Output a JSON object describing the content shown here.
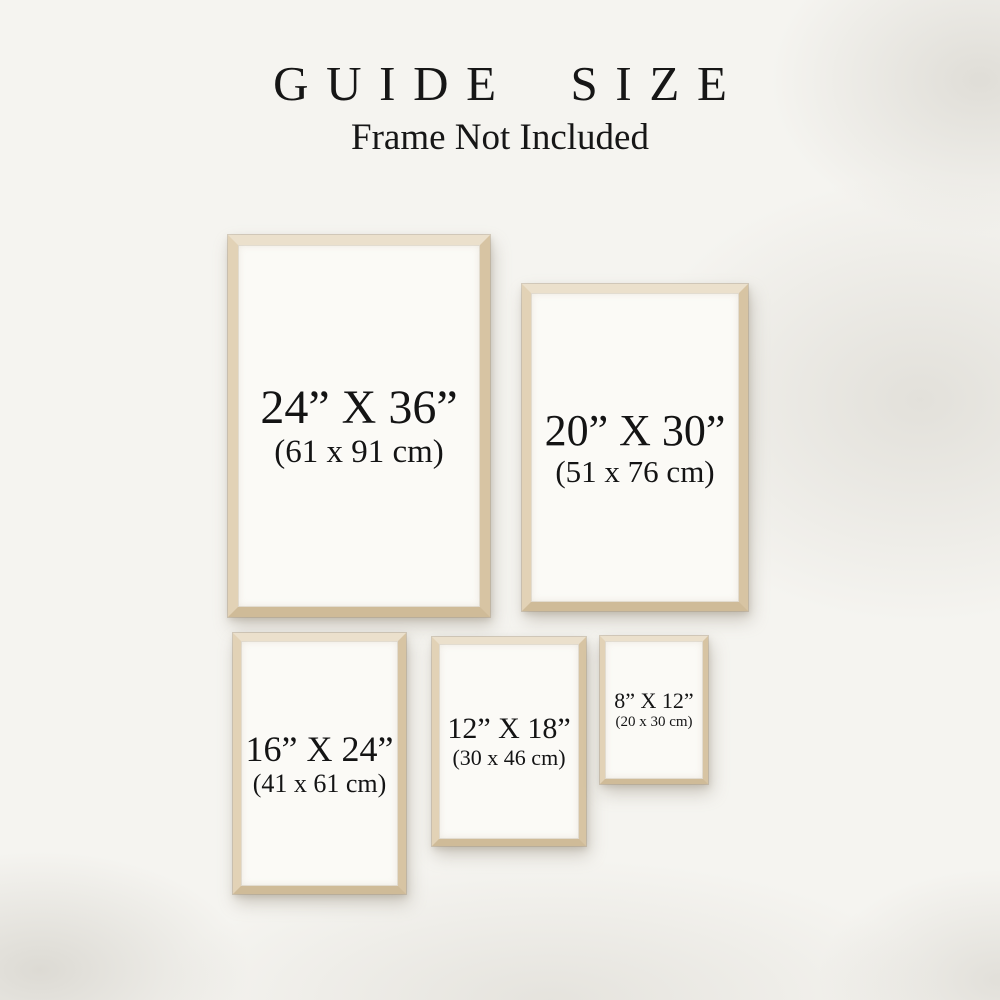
{
  "header": {
    "title": "GUIDE SIZE",
    "subtitle": "Frame Not Included"
  },
  "frames": [
    {
      "name": "24x36",
      "size_in": "24” X 36”",
      "size_cm": "(61 x 91 cm)"
    },
    {
      "name": "20x30",
      "size_in": "20” X 30”",
      "size_cm": "(51 x 76 cm)"
    },
    {
      "name": "16x24",
      "size_in": "16” X 24”",
      "size_cm": "(41 x 61 cm)"
    },
    {
      "name": "12x18",
      "size_in": "12” X 18”",
      "size_cm": "(30 x 46 cm)"
    },
    {
      "name": "8x12",
      "size_in": "8” X 12”",
      "size_cm": "(20 x 30 cm)"
    }
  ],
  "colors": {
    "background": "#f5f4f0",
    "background_shading": "#d2cfc7",
    "frame_wood_light": "#ebe0cc",
    "frame_wood_dark": "#cfbb98",
    "paper": "#fbfaf6",
    "text": "#141414"
  }
}
